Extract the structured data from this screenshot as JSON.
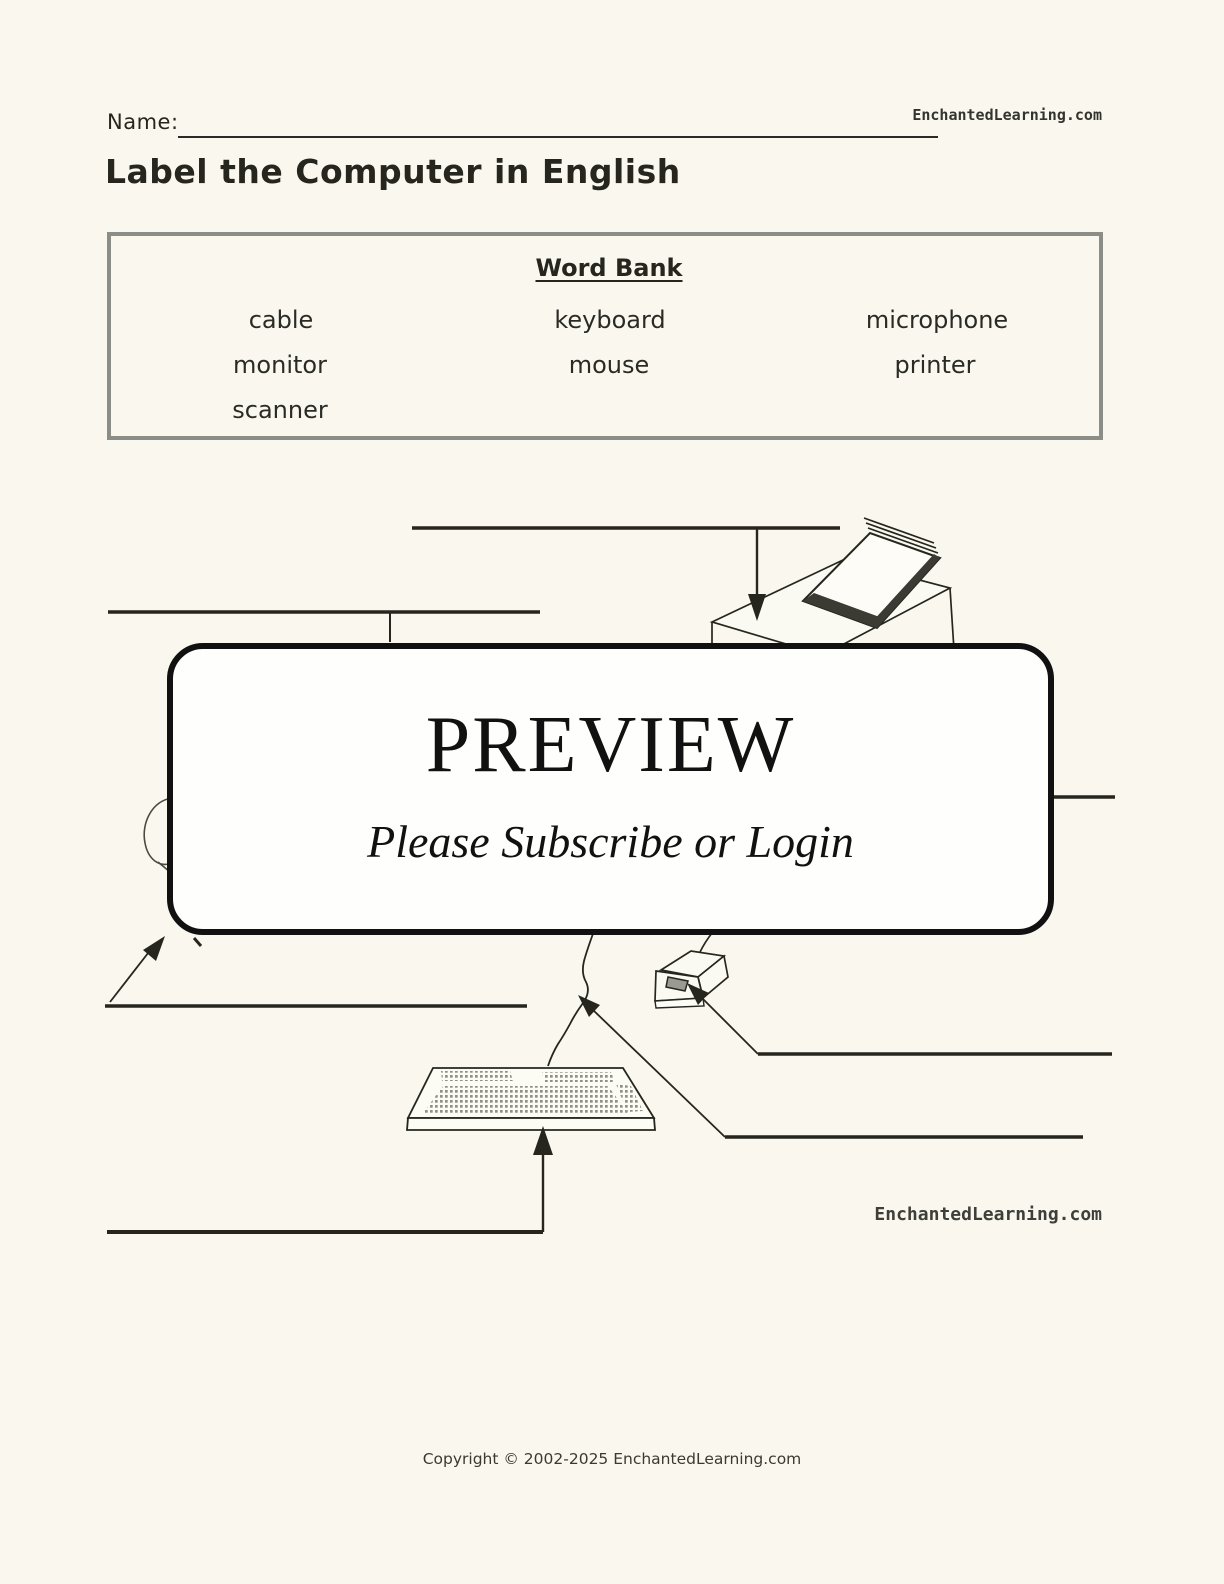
{
  "page": {
    "background": "#faf8ee",
    "ink": "#26261f",
    "border_gray": "#8d8d88"
  },
  "header": {
    "name_label": "Name:",
    "site": "EnchantedLearning.com"
  },
  "title": "Label the Computer in English",
  "word_bank": {
    "heading": "Word Bank",
    "words": [
      "cable",
      "keyboard",
      "microphone",
      "monitor",
      "mouse",
      "printer",
      "scanner"
    ]
  },
  "preview_overlay": {
    "heading": "PREVIEW",
    "subheading": "Please Subscribe or Login"
  },
  "diagram": {
    "watermark": "EnchantedLearning.com",
    "illustrations": [
      "printer",
      "monitor",
      "microphone",
      "mouse",
      "cable",
      "keyboard",
      "scanner"
    ]
  },
  "footer": {
    "copyright": "Copyright © 2002-2025 EnchantedLearning.com"
  }
}
